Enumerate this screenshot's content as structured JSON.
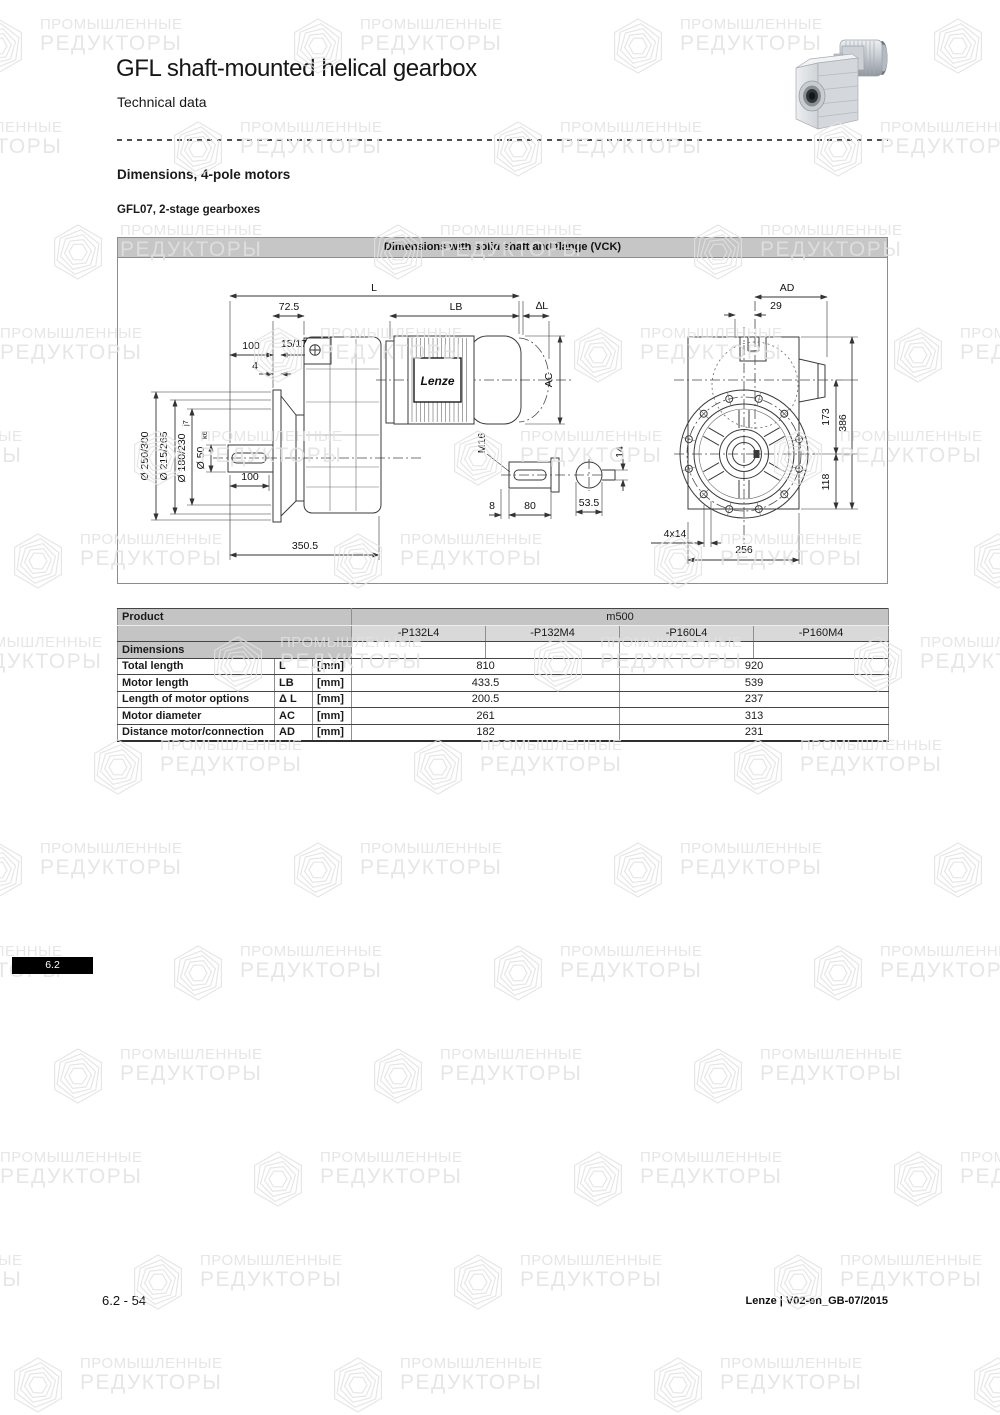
{
  "page": {
    "title": "GFL shaft-mounted helical gearbox",
    "subtitle": "Technical data",
    "section_heading": "Dimensions, 4-pole motors",
    "subsection_heading": "GFL07, 2-stage gearboxes",
    "section_tab": "6.2",
    "footer_left": "6.2 - 54",
    "footer_right": "Lenze | V02-en_GB-07/2015"
  },
  "watermark": {
    "line1": "ПРОМЫШЛЕННЫЕ",
    "line2": "РЕДУКТОРЫ"
  },
  "drawing": {
    "title": "Dimensions with solid shaft and flange (VCK)",
    "brand": "Lenze",
    "labels": {
      "L": "L",
      "len725": "72.5",
      "LB": "LB",
      "dL": "∆L",
      "top100": "100",
      "s1517": "15/17",
      "four": "4",
      "dia1": "Ø 250/300",
      "dia2": "Ø 215/265",
      "dia3": "Ø 180/230",
      "dia3s": "j7",
      "dia4": "Ø 50",
      "dia4s": "k6",
      "bot100": "100",
      "total": "350.5",
      "AC": "AC",
      "M16": "M16",
      "eight": "8",
      "eighty": "80",
      "d535": "53.5",
      "fourteen": "14",
      "AD": "AD",
      "tw9": "29",
      "h173": "173",
      "h386": "386",
      "h118": "118",
      "holes": "4x14",
      "w256": "256"
    }
  },
  "table": {
    "col_product": "Product",
    "group_header": "m500",
    "columns": [
      "-P132L4",
      "-P132M4",
      "-P160L4",
      "-P160M4"
    ],
    "section": "Dimensions",
    "rows": [
      {
        "label": "Total length",
        "symbol": "L",
        "unit": "[mm]",
        "v1": "810",
        "v2": "920"
      },
      {
        "label": "Motor length",
        "symbol": "LB",
        "unit": "[mm]",
        "v1": "433.5",
        "v2": "539"
      },
      {
        "label": "Length of motor options",
        "symbol": "Δ L",
        "unit": "[mm]",
        "v1": "200.5",
        "v2": "237"
      },
      {
        "label": "Motor diameter",
        "symbol": "AC",
        "unit": "[mm]",
        "v1": "261",
        "v2": "313"
      },
      {
        "label": "Distance motor/connection",
        "symbol": "AD",
        "unit": "[mm]",
        "v1": "182",
        "v2": "231"
      }
    ]
  },
  "colors": {
    "drawing_header_bg": "#c6c6c6",
    "table_header_bg": "#c4c4c4",
    "table_subheader_bg": "#d9d9d9",
    "tab_bg": "#000000",
    "watermark": "#e2e2e2"
  }
}
